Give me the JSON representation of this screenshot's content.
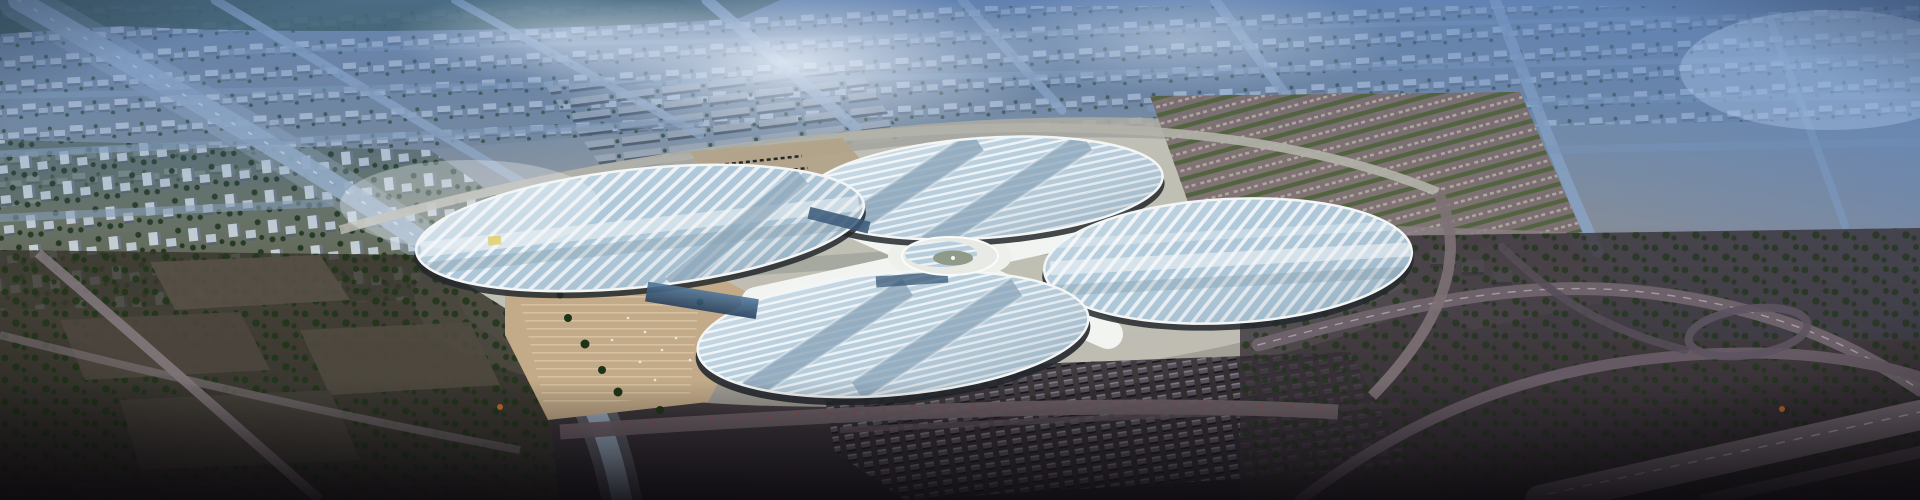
{
  "scene": {
    "name": "aerial-render-clover-exhibition-center",
    "type": "aerial architectural rendering",
    "subject": "four-petal clover-shaped exhibition center amid hazy city grid",
    "regions": [
      "city-grid-north",
      "blue-haze-sky",
      "clover-exhibition-center",
      "central-hub",
      "west-plaza",
      "northeast-parking-lots",
      "south-parking-rows",
      "southwest-warehouse-district",
      "highway-interchange-east"
    ]
  },
  "palette": {
    "sky_haze_blue": "#5c82bc",
    "haze_white": "#f2f8ff",
    "city_ground": "#7d8994",
    "city_block_light": "#c3cdd7",
    "city_block_shadow": "#5e6a77",
    "street_light": "#9db2c5",
    "tree_dark": "#1d3416",
    "petal_glass": "#b3cbdb",
    "petal_glass_side": "#a9c5d7",
    "petal_frame": "#edf2f6",
    "petal_rim": "#f4f6f5",
    "petal_underside": "#23282d",
    "roof_band_gray": "#8ba5b9",
    "hub_shell": "#e8eae6",
    "hub_sage": "#8f9b88",
    "plaza_tan": "#c3ab89",
    "plaza_step": "#dac7a4",
    "apron_gray": "#aeaca2",
    "ring_road": "#b2b2aa",
    "south_road": "#6e6167",
    "mauve_lot": "#7b6c6e",
    "hedge_green": "#4a6136",
    "bus_dark": "#5a555e",
    "dark_ground": "#383238",
    "ramp_gray": "#6d616a",
    "entrance_glass_blue": "#3a5878",
    "accent_yellow": "#d8c23a",
    "accent_orange": "#c96a2a"
  }
}
